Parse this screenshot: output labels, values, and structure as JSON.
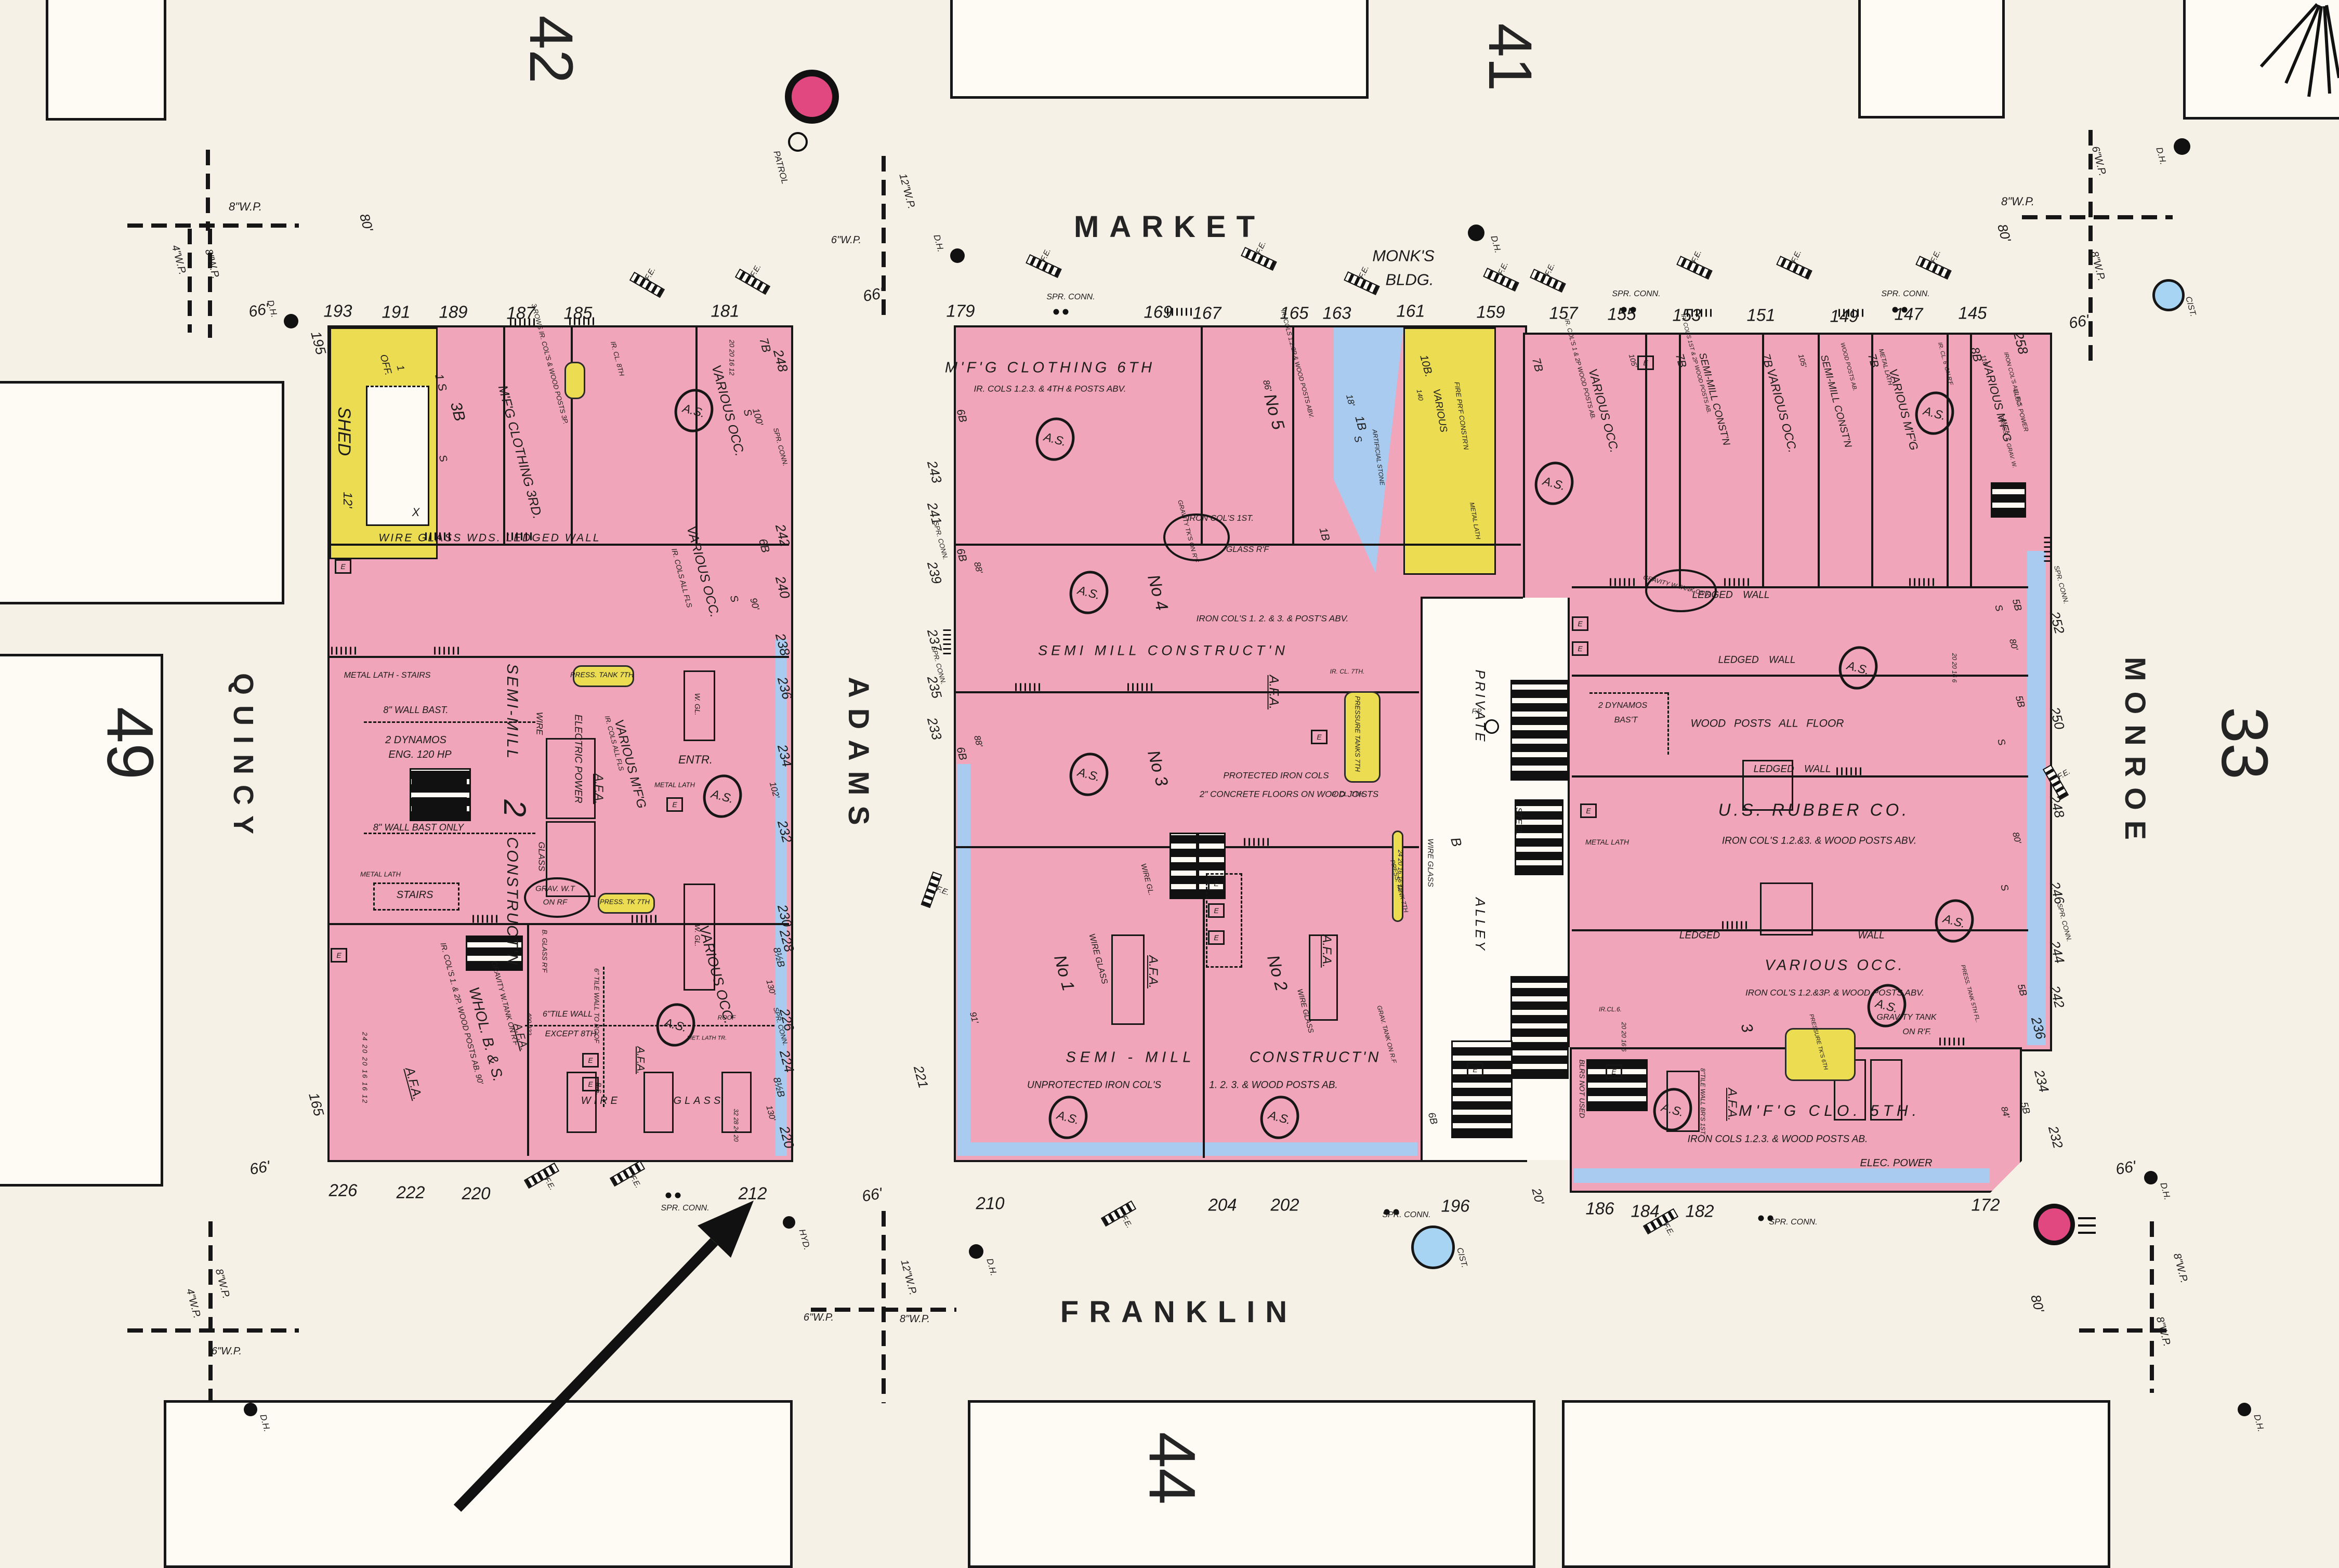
{
  "colors": {
    "paper": "#f6f1e6",
    "block_fill": "#fdfbf3",
    "pink": "#f0a5bb",
    "pink_deep": "#e0487f",
    "yellow": "#ecdc52",
    "blue": "#a9cbf0",
    "cistern_blue": "#a8d4f4",
    "ink": "#1b1b1b"
  },
  "streets": {
    "market": "MARKET",
    "franklin": "FRANKLIN",
    "adams": "ADAMS",
    "quincy": "QUINCY",
    "monroe": "MONROE"
  },
  "blocks": {
    "nw": "42",
    "ne": "41",
    "west": "49",
    "east": "33",
    "south": "44"
  },
  "legend": {
    "fe": "F.E.",
    "dh": "D.H.",
    "spr": "SPR. CONN.",
    "spr1": "SPR.",
    "spr2": "CONN.",
    "cist": "CIST.",
    "hyd": "HYD.",
    "patrol": "PATROL",
    "as": "A.S.",
    "e": "E",
    "wp8": "8\"W.P.",
    "wp6": "6\"W.P.",
    "wp4": "4\"W.P.",
    "wp12": "12\"W.P."
  },
  "common": {
    "ledged_wall": "LEDGED WALL",
    "ledged": "LEDGED",
    "wall": "WALL",
    "various_occ": "VARIOUS OCC.",
    "metal_lath": "METAL LATH",
    "wire_glass": "WIRE GLASS",
    "afa": "A.F.A.",
    "stairs": "STAIRS",
    "semi_mill": "SEMI-MILL CONST'N",
    "various_mfg": "VARIOUS M'F'G",
    "elec_power": "ELEC. POWER"
  },
  "grades": {
    "b1": "1B",
    "b3": "3B",
    "b5": "5B",
    "b6": "6B",
    "b7": "7B",
    "b8": "8B",
    "b8h": "8½B",
    "b10": "10B.",
    "s": "S"
  },
  "dims": {
    "d12": "12'",
    "d18": "18'",
    "d20": "20'",
    "d66": "66'",
    "d80": "80'",
    "d84": "84'",
    "d86": "86'",
    "d88": "88'",
    "d90": "90'",
    "d91": "91'",
    "d100": "100'",
    "d102": "102'",
    "d105": "105'",
    "d110": "110'",
    "d130": "130'"
  },
  "left": {
    "shed": "SHED",
    "off": "OFF.",
    "one": "1",
    "x": "X",
    "s1": "1 S",
    "mfg_clothing": "M'F'G CLOTHING 3RD.",
    "rows": "3 ROWS IR. COL'S & WOOD POSTS 3P.",
    "ircl8": "IR. CL. 8TH",
    "wds_line": "WIRE  GLASS  WDS.   LEDGED  WALL",
    "ir_cols_all_fls": "IR. COLS ALL FLS",
    "metal_lath_stairs": "METAL LATH - STAIRS",
    "press_tank7": "PRESS. TANK 7TH",
    "press_tk7": "PRESS. TK 7TH",
    "wall_bast": "8\" WALL BAST.",
    "wall_bast_only": "8\" WALL BAST ONLY",
    "dynamos1": "2 DYNAMOS",
    "dynamos2": "ENG. 120 HP",
    "semi1": "SEMI-MILL",
    "semi2": "2",
    "semi3": "CONSTRUCT'N",
    "wire": "WIRE",
    "glass": "GLASS",
    "electric_power": "ELECTRIC POWER",
    "entr": "ENTR.",
    "wgl": "W. GL.",
    "grav1": "GRAV. W.T",
    "grav2": "ON RF",
    "bglass": "B. GLASS R'F",
    "ircols12": "IR. COL'S 1. & 2P. WOOD POSTS AB. 90'",
    "whol": "WHOL. B. & S.",
    "joists": "24 20 20 16 16 12",
    "joists2": "32 28 24 20",
    "nums400": "400 222",
    "gravity_tank": "GRAVITY W.TANK ON R'F",
    "tile_to_roof": "6\" TILE WALL TO ROOF",
    "tile1": "6\"TILE WALL",
    "tile2": "EXCEPT 8TH",
    "roof": "ROOF",
    "bs": "B.S.",
    "met_lath_tr": "MET. LATH TR.",
    "col20": "20 20 16 12"
  },
  "mid": {
    "mfg6": "M'F'G CLOTHING 6TH",
    "ircols1234": "IR. COLS 1.2.3. & 4TH & POSTS ABV.",
    "monks1": "MONK'S",
    "monks2": "BLDG.",
    "no5": "No 5",
    "no4": "No 4",
    "no3": "No 3",
    "no1": "No 1",
    "no2": "No 2",
    "ircols_posts": "IR. COLS 1.2.3P & WOOD POSTS ABV.",
    "ircols1st": "IRON COL'S 1ST.",
    "glassrf": "GLASS R'F",
    "gravity_tks": "GRAVITY TK'S ON R'F",
    "ircols123": "IRON COL'S 1. 2. & 3. & POST'S ABV.",
    "semi_mill": "SEMI MILL CONSTRUCT'N",
    "protected": "PROTECTED IRON COLS",
    "concrete": "2\" CONCRETE FLOORS ON WOOD JOISTS",
    "pressure_tanks": "PRESSURE TANKS 7TH",
    "ircl7": "IR. CL. 7TH.",
    "semi1": "SEMI - MILL",
    "semi2": "CONSTRUCT'N",
    "unprotected": "UNPROTECTED IRON COL'S",
    "posts123": "1. 2. 3. & WOOD POSTS AB.",
    "wire_gl": "WIRE GL.",
    "press_tank7": "PRESS. TANK 7TH",
    "grav_tank": "GRAV. TANK ON R.F",
    "artificial": "ARTIFICIAL STONE",
    "various": "VARIOUS",
    "firepf": "FIRE PR'F CONSTR'N",
    "n140": "140",
    "joists": "24 20 16 16 12"
  },
  "alley": {
    "private": "PRIVATE",
    "alley": "ALLEY",
    "b": "B",
    "steel": "STEEL",
    "fp": "F.P."
  },
  "right": {
    "ircols12w": "IR. COL'S 1 & 2P WOOD POSTS AB.",
    "semi_ir": "IR. COL'S 1ST & 2P WOOD POSTS AB.",
    "wood_posts_ab": "WOOD POSTS AB.",
    "ircl6rf": "IR. CL. 6' ON R'F",
    "ircols_allfls": "IRON COL'S ALL FLS",
    "press_grav": "PRESS. T. GRAV. W.",
    "gravity_wtank": "GRAVITY W.TANK ON R.",
    "dynamos1": "2 DYNAMOS",
    "dynamos2": "BAS'T",
    "wood_posts_floor": "WOOD POSTS ALL FLOOR",
    "us_rubber": "U.S. RUBBER CO.",
    "rubber_sub": "IRON COL'S 1.2.&3. & WOOD POSTS ABV.",
    "occ_sub1": "IRON COL'S 1.2.&3P. & WOOD POSTS ABV.",
    "occ_sub2": "IRON COLS 1.2.3. & WOOD POSTS ABV.",
    "press_tk5": "PRESS. TANK 5TH FL.",
    "gravity_tank1": "GRAVITY TANK",
    "gravity_tank2": "ON R'F.",
    "press_tks6": "PRESSURE TK'S 6TH",
    "ircl6": "IR.CL.6.",
    "mfg_clo": "M'F'G CLO. 5TH.",
    "mfg_sub": "IRON COLS 1.2.3. & WOOD POSTS AB.",
    "blrs": "BLRS NOT USED",
    "tile8": "8\"TILE WALL BR'S 1ST.",
    "three": "3",
    "joists1": "20 20 16 6"
  },
  "edge": {
    "left_top": [
      "193",
      "191",
      "189",
      "187",
      "185",
      "181"
    ],
    "left_bottom": [
      "226",
      "222",
      "220",
      "212"
    ],
    "left_west": [
      "195",
      "165"
    ],
    "adams_w": [
      "248",
      "242",
      "240",
      "238",
      "236",
      "234",
      "232",
      "230",
      "228",
      "226",
      "224",
      "220"
    ],
    "adams_e": [
      "243",
      "241",
      "239",
      "237",
      "235",
      "233",
      "221"
    ],
    "mid_top": [
      "179",
      "169",
      "167",
      "165",
      "163",
      "161",
      "159"
    ],
    "mid_bottom": [
      "210",
      "204",
      "202",
      "196"
    ],
    "right_top": [
      "157",
      "155",
      "153",
      "151",
      "149",
      "147",
      "145"
    ],
    "monroe_e": [
      "258",
      "252",
      "250",
      "248",
      "246",
      "244",
      "242",
      "236",
      "234",
      "232"
    ],
    "right_bottom": [
      "186",
      "184",
      "182",
      "172"
    ]
  }
}
